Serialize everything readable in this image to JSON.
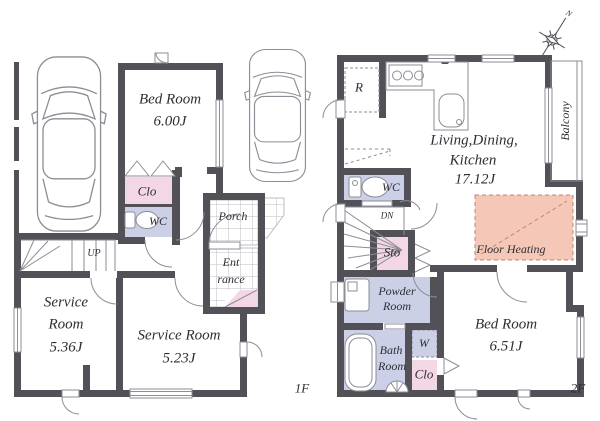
{
  "colors": {
    "wall": "#515157",
    "line": "#8d8d95",
    "tile-line": "#bcbcc2",
    "closet-pink": "#f3d7e4",
    "wet-lavender": "#cbd0e7",
    "heating-salmon": "#f5c7b7",
    "heating-border": "#cd8170",
    "text": "#2e2e34"
  },
  "floor1": {
    "floor_label": "1F",
    "stairs_label": "UP",
    "bedroom": {
      "name": "Bed Room",
      "size": "6.00J"
    },
    "closet": "Clo",
    "wc": "WC",
    "porch": "Porch",
    "entrance_line1": "Ent",
    "entrance_line2": "rance",
    "service_room_1": {
      "name_line1": "Service",
      "name_line2": "Room",
      "size": "5.36J"
    },
    "service_room_2": {
      "name": "Service Room",
      "size": "5.23J"
    }
  },
  "floor2": {
    "floor_label": "2F",
    "stairs_label": "DN",
    "refrigerator": "R",
    "ldk": {
      "name_line1": "Living,Dining,",
      "name_line2": "Kitchen",
      "size": "17.12J"
    },
    "balcony": "Balcony",
    "wc": "WC",
    "storage": "Sto",
    "powder_room": {
      "line1": "Powder",
      "line2": "Room"
    },
    "bath_room": {
      "line1": "Bath",
      "line2": "Room"
    },
    "washer": "W",
    "closet": "Clo",
    "bedroom": {
      "name": "Bed Room",
      "size": "6.51J"
    },
    "floor_heating": "Floor Heating"
  },
  "compass": {
    "north": "N"
  }
}
